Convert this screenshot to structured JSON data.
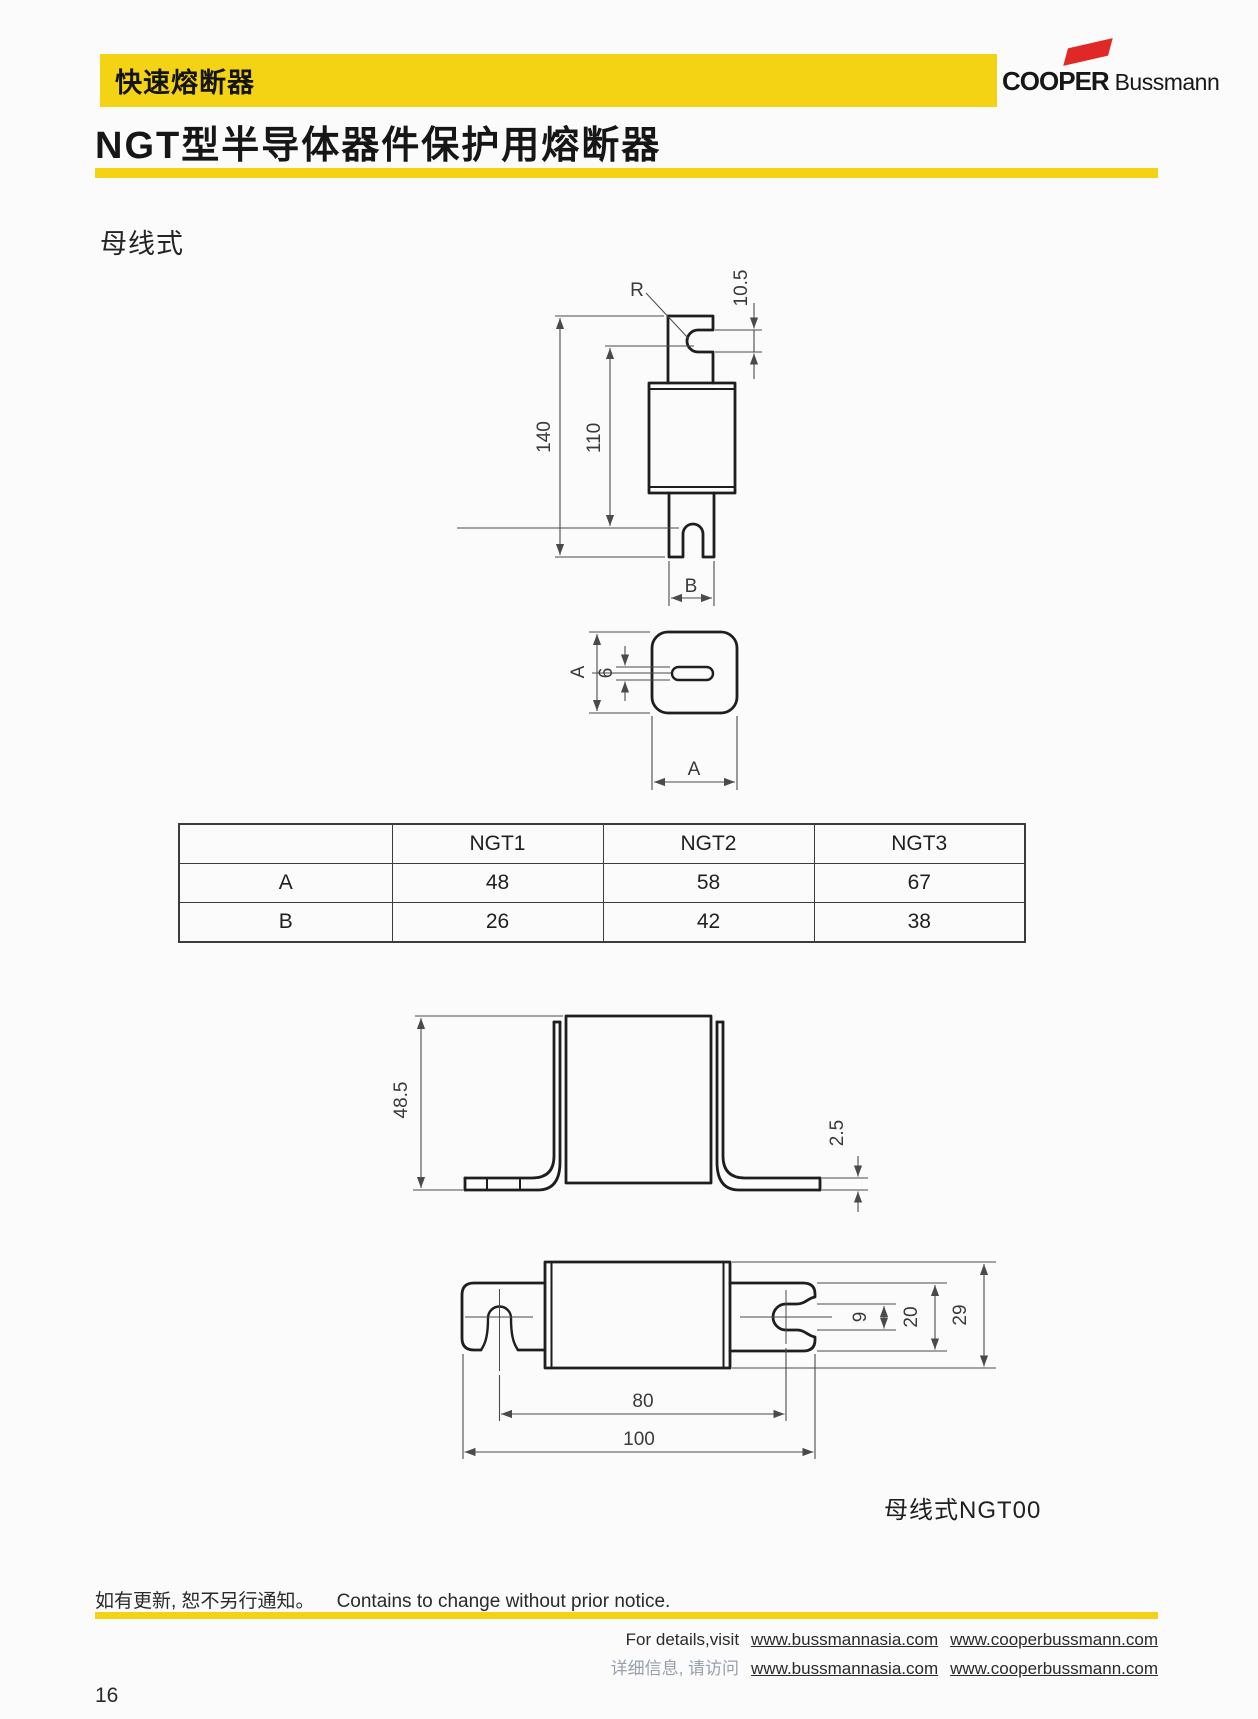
{
  "header": {
    "category": "快速熔断器",
    "brand_bold": "COOPER",
    "brand_regular": " Bussmann"
  },
  "title": "NGT型半导体器件保护用熔断器",
  "section_label": "母线式",
  "drawing_labels": {
    "side": {
      "r": "R",
      "notch": "10.5",
      "h140": "140",
      "h110": "110",
      "b": "B"
    },
    "top": {
      "a_left": "A",
      "slot6": "6",
      "a_bottom": "A"
    },
    "bracket": {
      "h485": "48.5",
      "t25": "2.5"
    },
    "bottom": {
      "d9": "9",
      "d20": "20",
      "d29": "29",
      "d80": "80",
      "d100": "100",
      "caption": "母线式NGT00"
    }
  },
  "table": {
    "columns": [
      "NGT1",
      "NGT2",
      "NGT3"
    ],
    "rows": [
      {
        "label": "A",
        "values": [
          "48",
          "58",
          "67"
        ]
      },
      {
        "label": "B",
        "values": [
          "26",
          "42",
          "38"
        ]
      }
    ]
  },
  "footer": {
    "notice_zh": "如有更新, 恕不另行通知。",
    "notice_en": "Contains to change without prior notice.",
    "details_en_prefix": "For details,visit",
    "details_zh_prefix": "详细信息, 请访问",
    "site1": "www.bussmannasia.com",
    "site2": "www.cooperbussmann.com",
    "page_number": "16"
  },
  "colors": {
    "accent_yellow": "#F4D214",
    "logo_red": "#E02826",
    "line_color": "#1e1e1e"
  }
}
